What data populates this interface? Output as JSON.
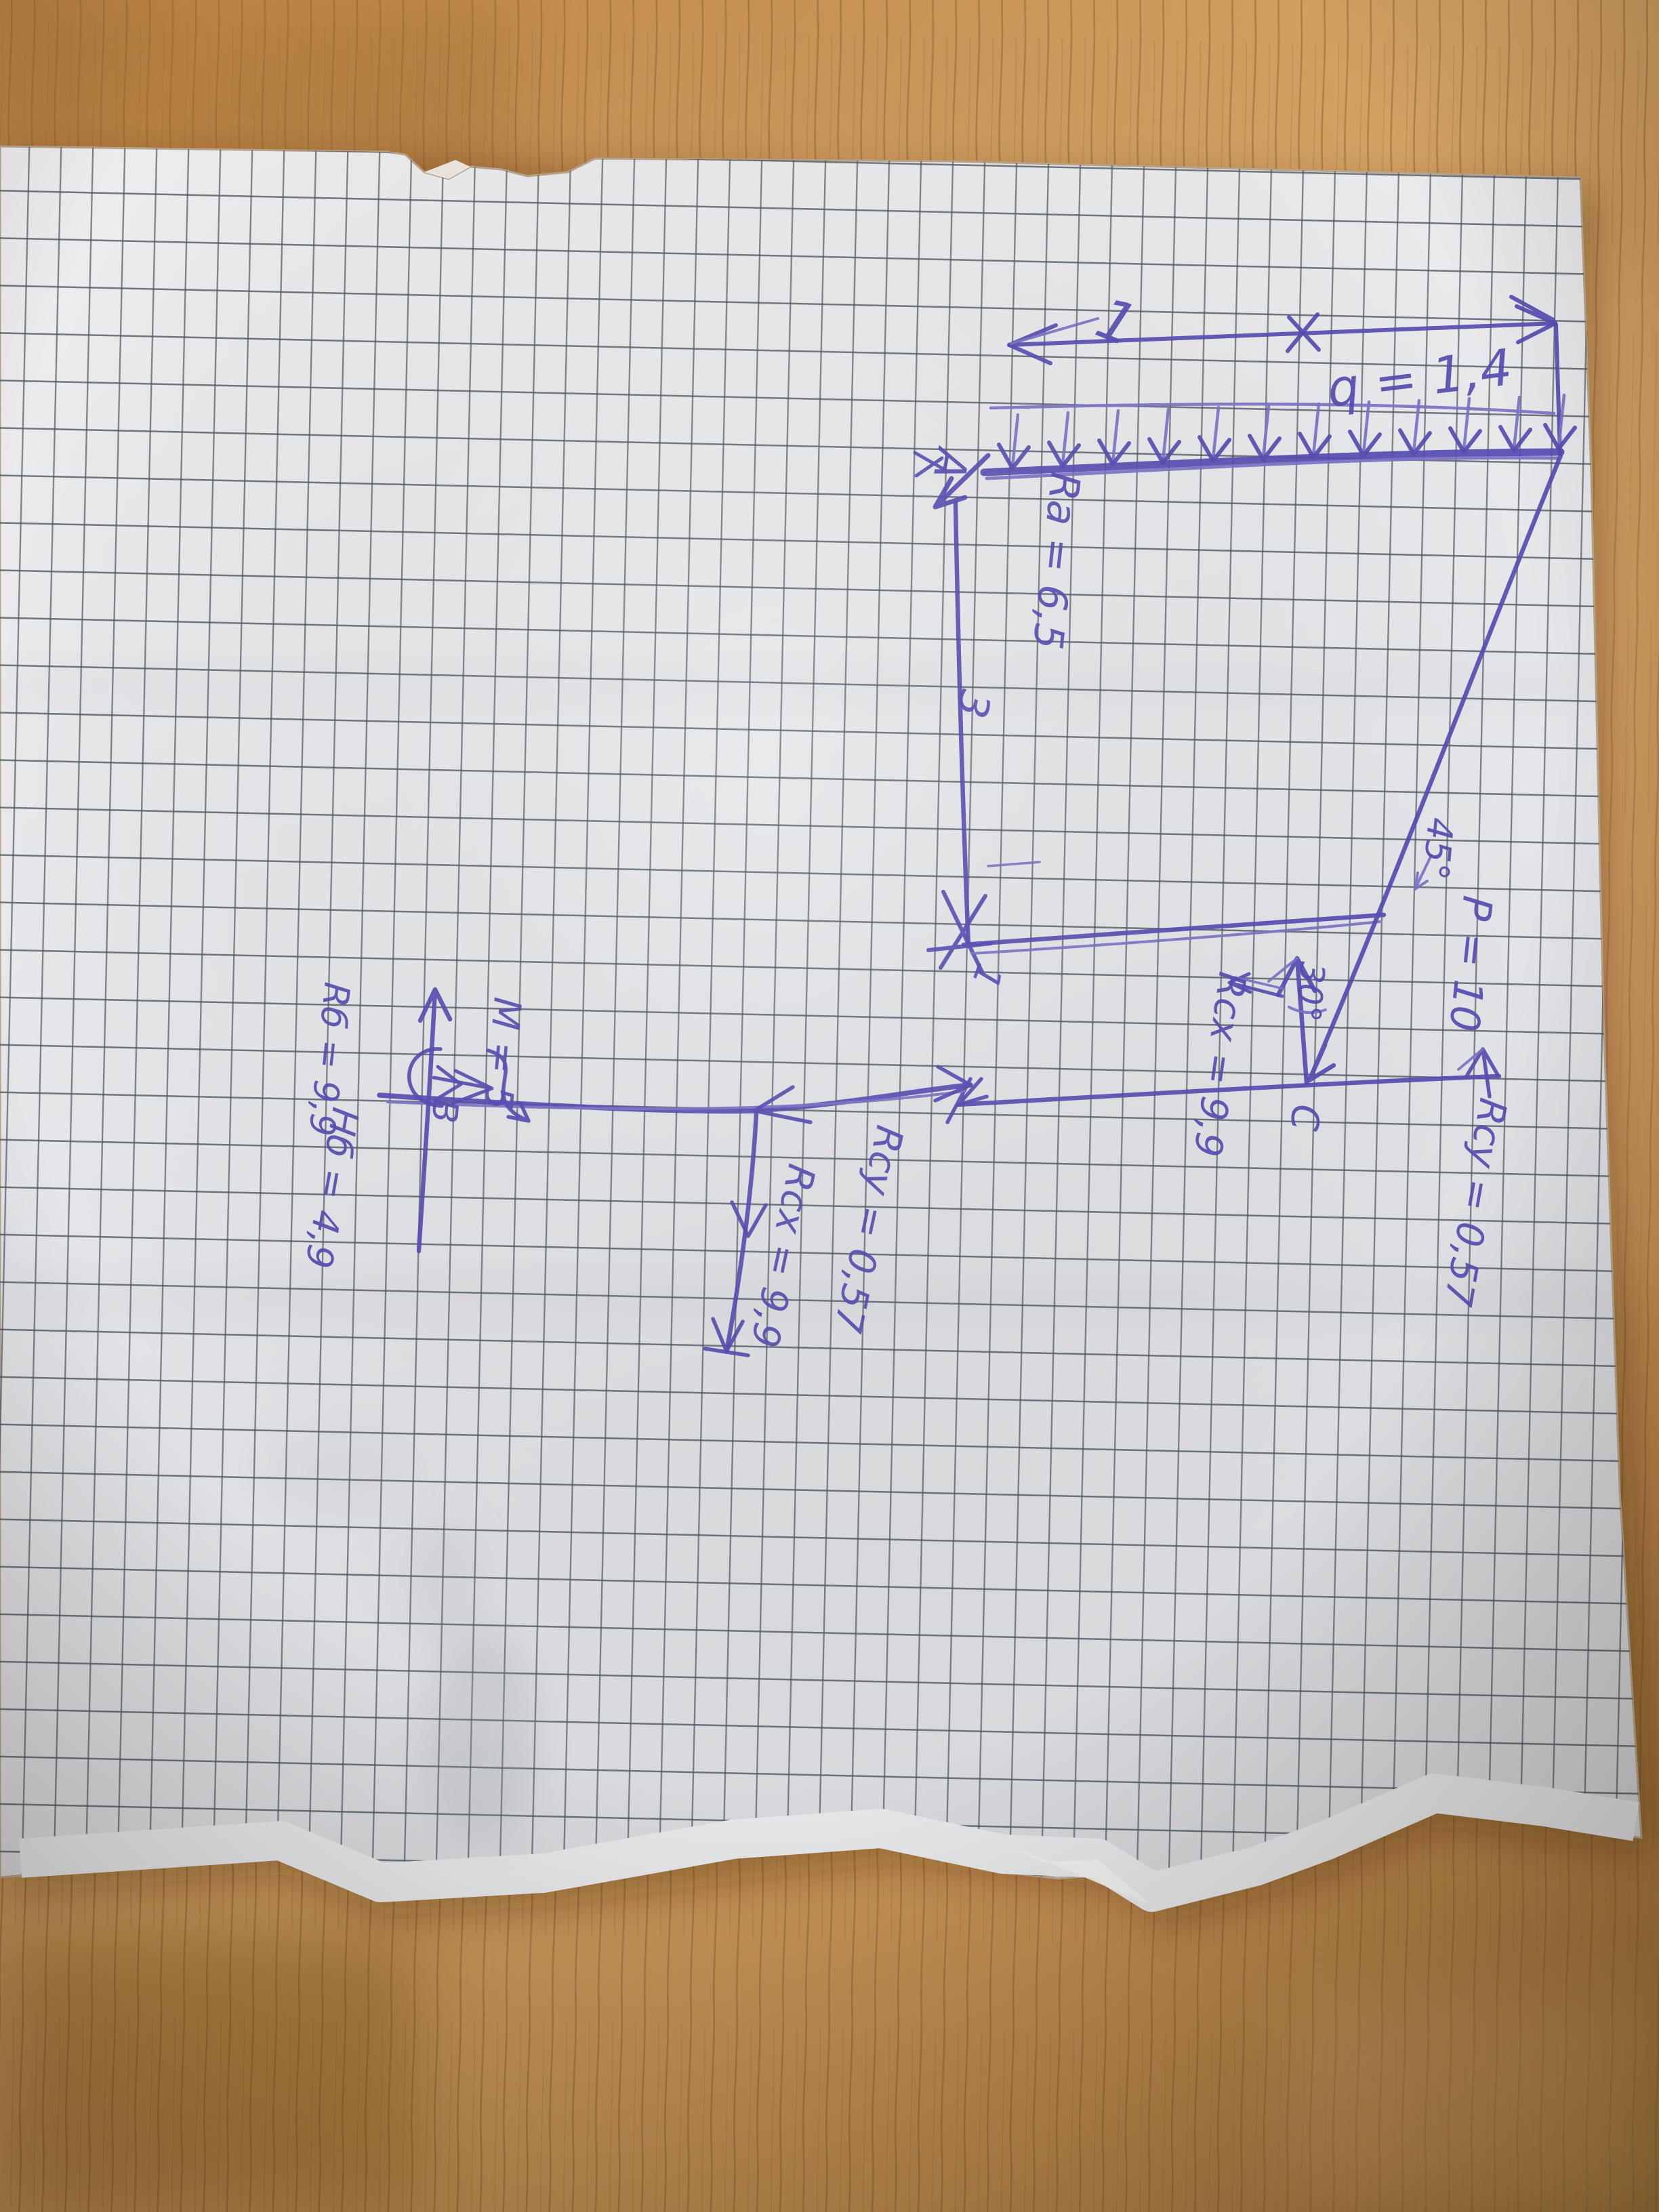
{
  "diagram_labels": {
    "dim_top": "1",
    "load_q": "q = 1,4",
    "point_a": "A",
    "reaction_ra": "Ra = 6,5",
    "dim_vertical": "3",
    "dim_corner": "1",
    "angle_p": "45°",
    "force_p": "P = 10",
    "angle_c": "30°",
    "reaction_rcx_upper": "Rcx = 9,9",
    "point_c": "C",
    "reaction_rcy_upper": "Rcy = 0,57",
    "moment_m": "M = 5",
    "reaction_rcy_lower": "Rcy = 0,57",
    "reaction_rcx_lower": "Rcx = 9,9",
    "point_b": "B",
    "reaction_rb": "Rб = 9,9",
    "reaction_hb": "Нб = 4,9"
  },
  "colors": {
    "ink": "#564cb2",
    "paper": "#e8e9eb",
    "grid_lines": "#4d565f",
    "wood_desk": "#c9975a"
  }
}
